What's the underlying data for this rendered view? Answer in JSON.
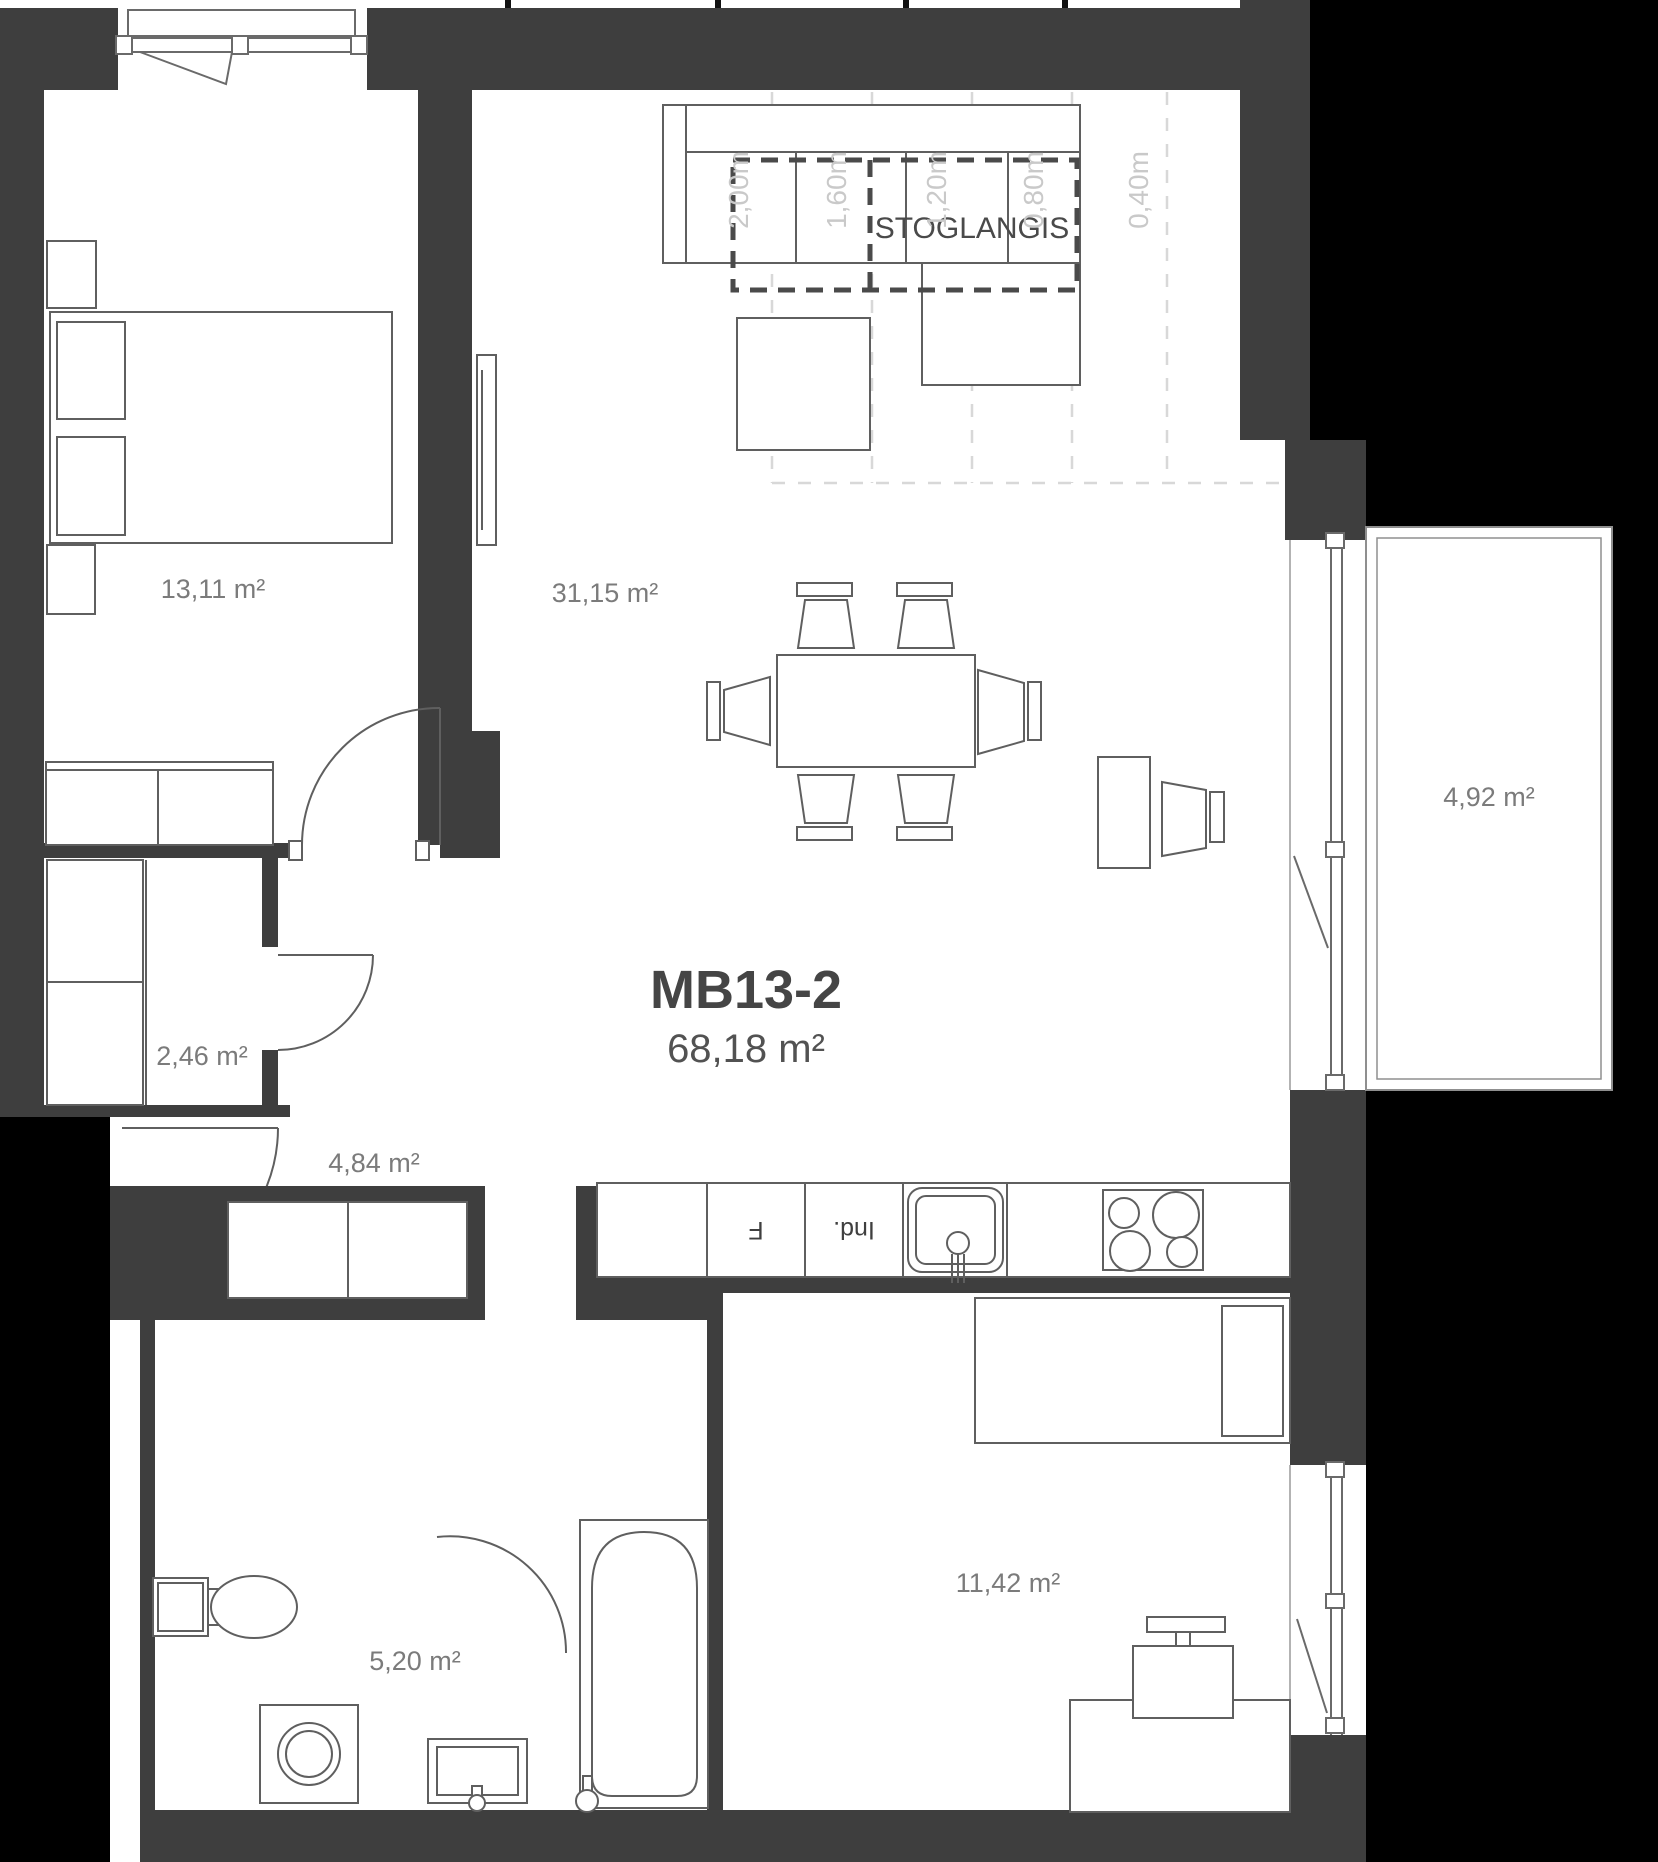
{
  "plan": {
    "unit": {
      "id": "MB13-2",
      "total_area": "68,18 m²"
    },
    "rooms": {
      "bedroom1": "13,11 m²",
      "living": "31,15 m²",
      "closet": "2,46 m²",
      "hallway": "4,84 m²",
      "bathroom": "5,20 m²",
      "bedroom2": "11,42 m²",
      "balcony": "4,92 m²"
    },
    "skylight": "STOGLANGIS",
    "roof_heights": [
      "2,00m",
      "1,60m",
      "1,20m",
      "0,80m",
      "0,40m"
    ],
    "kitchen": {
      "fridge": "F",
      "dishwasher": "Ind."
    },
    "colors": {
      "wall": "#3e3e3e",
      "outside": "#000000",
      "furniture_line": "#5f5f5f",
      "room_label": "#7b7b7b",
      "title": "#454545",
      "dimension": "#c9c9c9"
    }
  }
}
